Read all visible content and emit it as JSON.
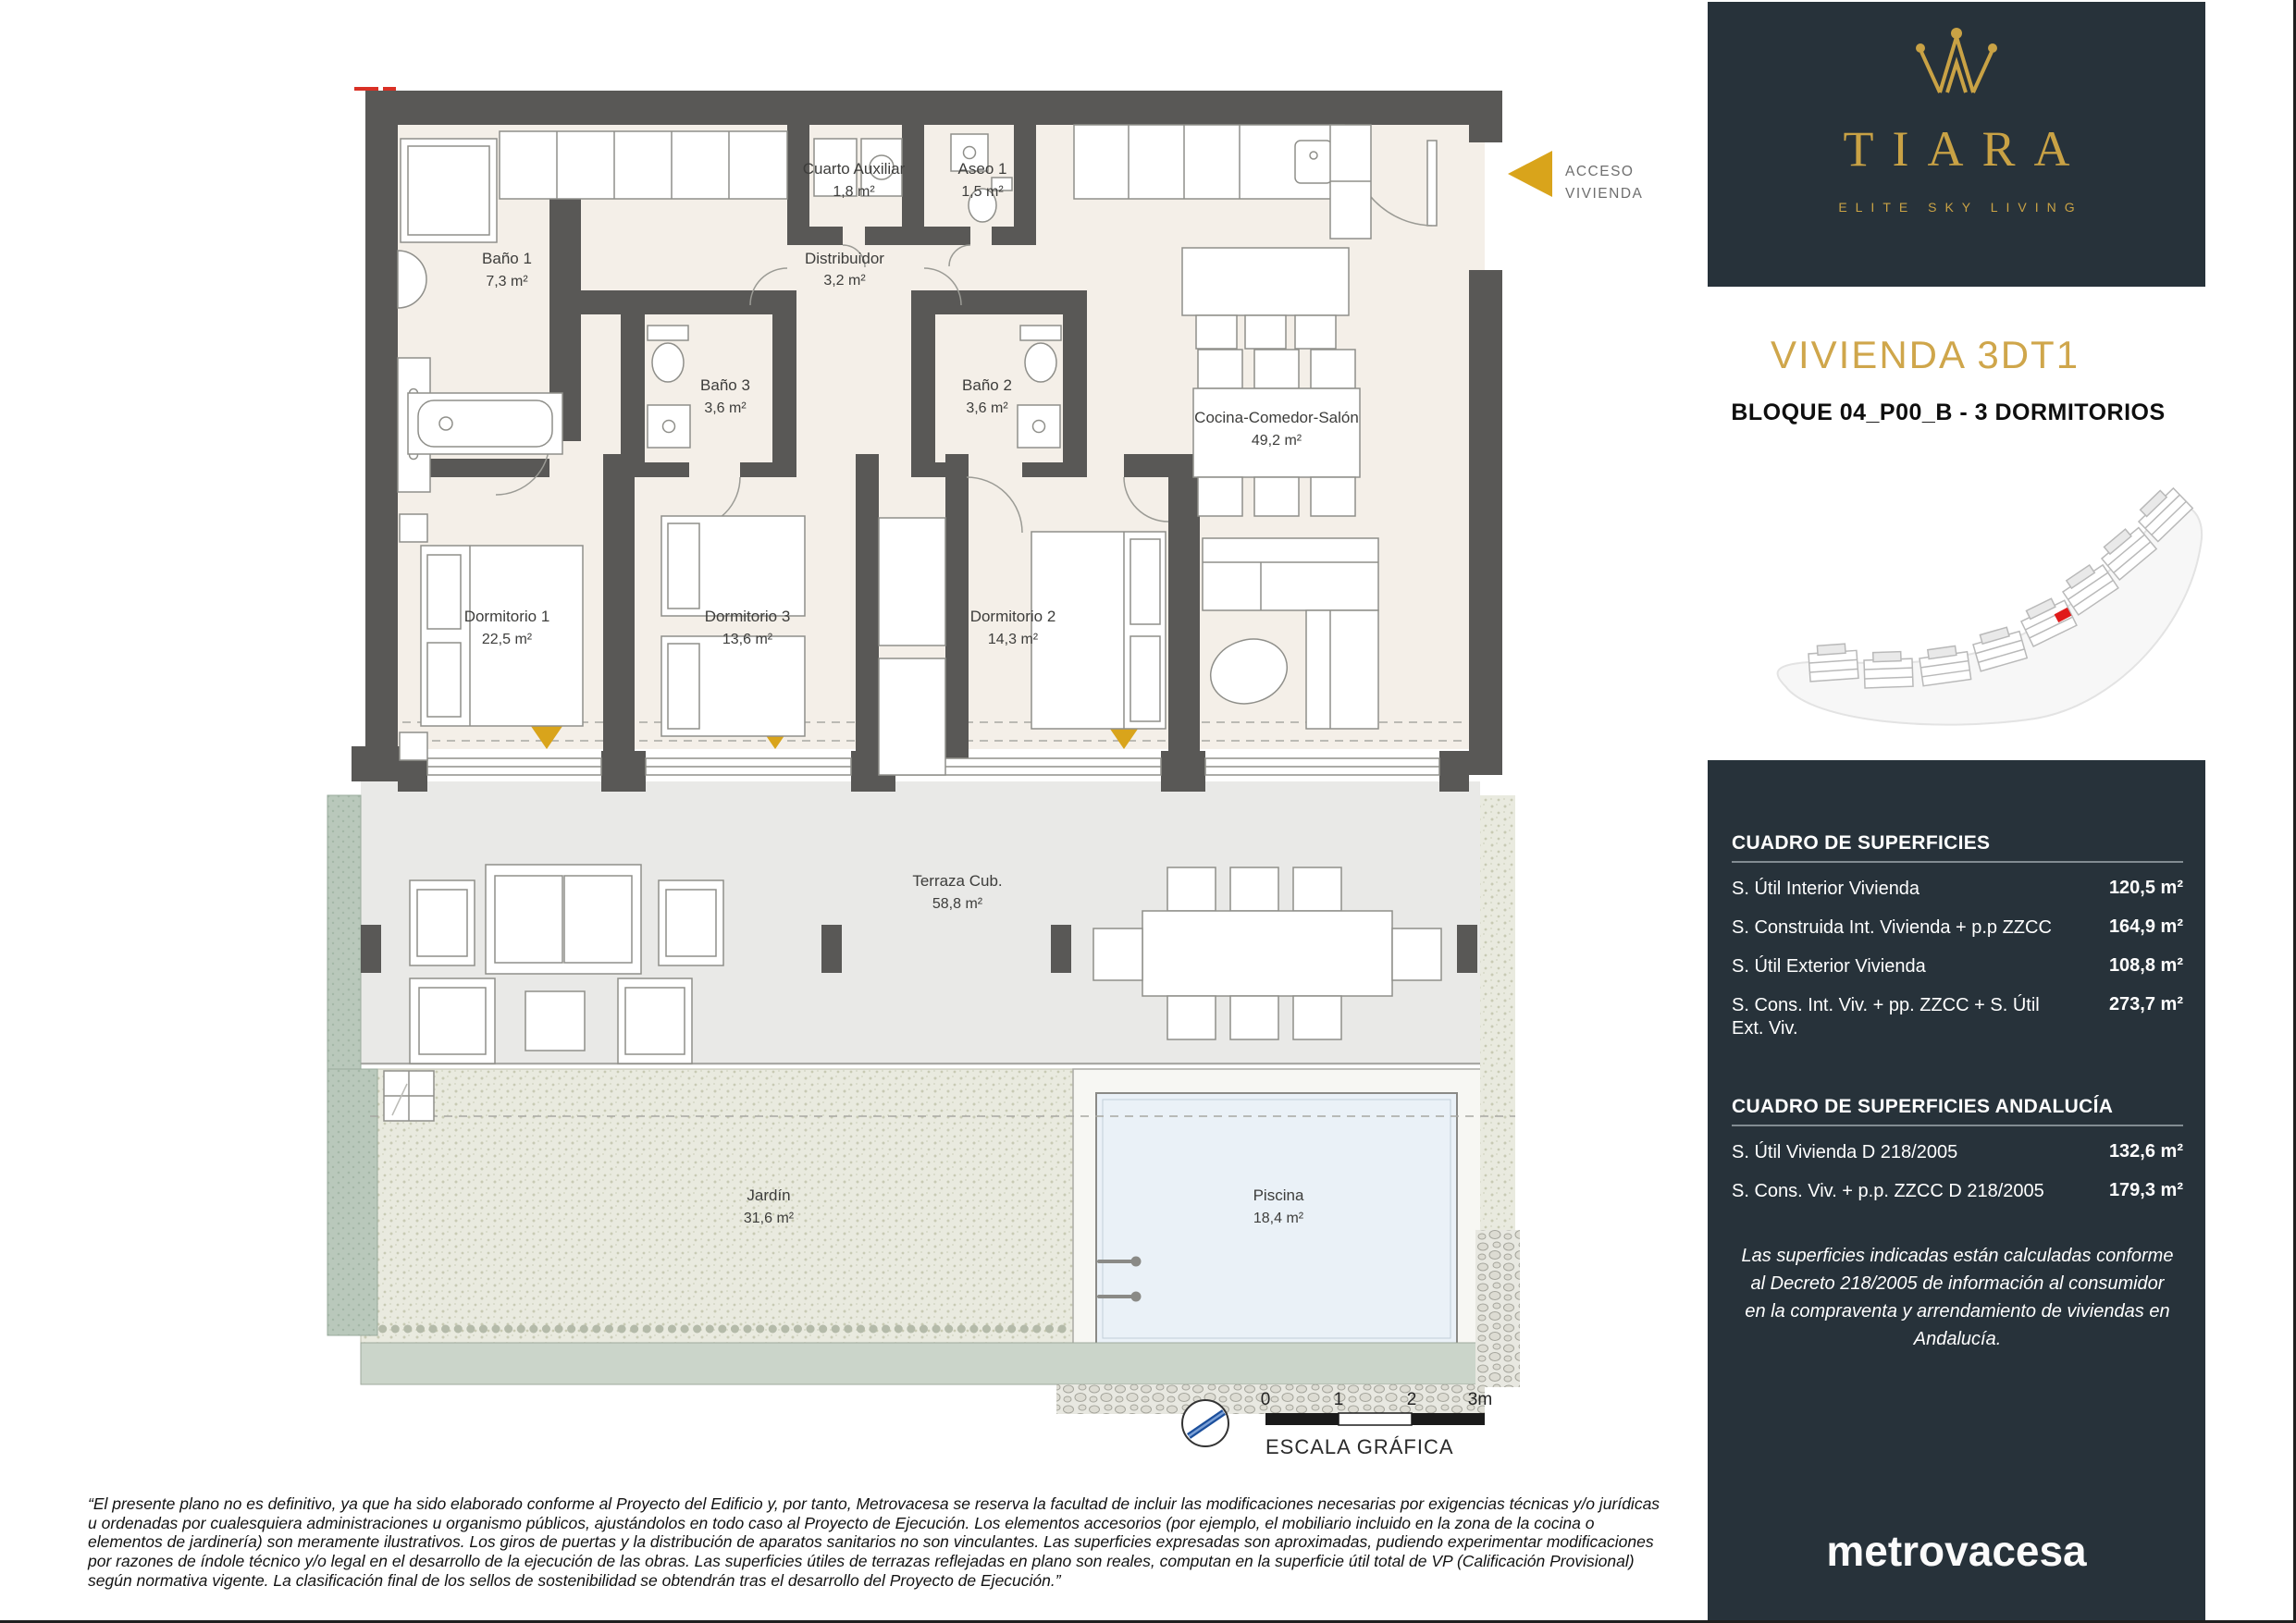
{
  "plan": {
    "access": {
      "line1": "ACCESO",
      "line2": "VIVIENDA"
    },
    "rooms": [
      {
        "name": "Baño 1",
        "area": "7,3 m²"
      },
      {
        "name": "Cuarto Auxiliar",
        "area": "1,8 m²"
      },
      {
        "name": "Aseo 1",
        "area": "1,5 m²"
      },
      {
        "name": "Distribuidor",
        "area": "3,2 m²"
      },
      {
        "name": "Baño 3",
        "area": "3,6 m²"
      },
      {
        "name": "Baño 2",
        "area": "3,6 m²"
      },
      {
        "name": "Dormitorio 1",
        "area": "22,5 m²"
      },
      {
        "name": "Dormitorio 3",
        "area": "13,6 m²"
      },
      {
        "name": "Dormitorio 2",
        "area": "14,3 m²"
      },
      {
        "name": "Cocina-Comedor-Salón",
        "area": "49,2 m²"
      },
      {
        "name": "Terraza Cub.",
        "area": "58,8 m²"
      },
      {
        "name": "Jardín",
        "area": "31,6 m²"
      },
      {
        "name": "Piscina",
        "area": "18,4 m²"
      }
    ],
    "scale": {
      "t0": "0",
      "t1": "1",
      "t2": "2",
      "t3": "3m",
      "caption": "ESCALA GRÁFICA"
    }
  },
  "sidebar": {
    "brand": {
      "name": "TIARA",
      "tagline": "ELITE SKY LIVING"
    },
    "title": "VIVIENDA 3DT1",
    "subtitle": "BLOQUE 04_P00_B - 3 DORMITORIOS",
    "surfaces": {
      "title": "CUADRO DE SUPERFICIES",
      "rows": [
        {
          "label": "S. Útil Interior Vivienda",
          "value": "120,5 m²"
        },
        {
          "label": "S. Construida Int. Vivienda + p.p ZZCC",
          "value": "164,9 m²"
        },
        {
          "label": "S. Útil Exterior Vivienda",
          "value": "108,8 m²"
        },
        {
          "label": "S. Cons. Int. Viv. + pp. ZZCC + S. Útil Ext. Viv.",
          "value": "273,7 m²"
        }
      ]
    },
    "surfaces_andalucia": {
      "title": "CUADRO DE SUPERFICIES ANDALUCÍA",
      "rows": [
        {
          "label": "S. Útil Vivienda D 218/2005",
          "value": "132,6 m²"
        },
        {
          "label": "S. Cons. Viv. + p.p. ZZCC D 218/2005",
          "value": "179,3 m²"
        }
      ],
      "note": "Las superficies indicadas están calculadas conforme al Decreto 218/2005 de información al consumidor en la compraventa y arrendamiento de viviendas en Andalucía."
    },
    "developer_logo": "metrovacesa"
  },
  "footer": {
    "disclaimer": "“El presente plano no es definitivo, ya que ha sido elaborado conforme al Proyecto del Edificio y, por tanto, Metrovacesa se reserva la facultad de incluir las modificaciones necesarias por exigencias técnicas y/o jurídicas u ordenadas por cualesquiera administraciones u organismo públicos, ajustándolos en todo caso al Proyecto de Ejecución. Los elementos accesorios (por ejemplo, el mobiliario incluido en la zona de la cocina o elementos de jardinería) son meramente ilustrativos. Los giros de puertas y la distribución de aparatos sanitarios no son vinculantes. Las superficies expresadas son aproximadas, pudiendo experimentar modificaciones por razones de índole técnico y/o legal en el desarrollo de la ejecución de las obras. Las superficies útiles de terrazas reflejadas en plano son reales, computan en la superficie útil total de VP (Calificación Provisional) según normativa vigente. La clasificación final de los sellos de sostenibilidad se obtendrán tras el desarrollo del Proyecto de Ejecución.”"
  },
  "colors": {
    "accent_gold": "#C9A245",
    "arrow_gold": "#D9A41B",
    "panel_dark": "#27323A",
    "wall": "#595856",
    "floor_cream": "#F4EFE8",
    "terrace_gray": "#E9E9E7",
    "garden_green": "#E9EADF",
    "pool_blue": "#EAF1F7",
    "planter_green": "#B9C8BB",
    "unit_marker_red": "#E01B1B"
  }
}
